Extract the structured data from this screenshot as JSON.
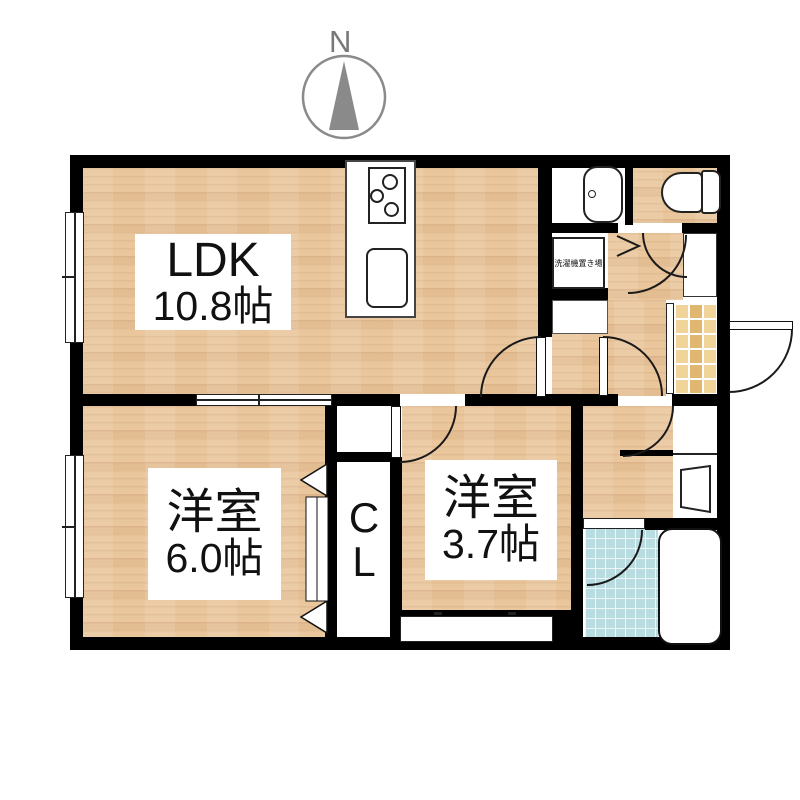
{
  "compass": {
    "label": "N"
  },
  "rooms": {
    "ldk": {
      "name": "LDK",
      "area": "10.8帖"
    },
    "western1": {
      "name": "洋室",
      "area": "6.0帖"
    },
    "western2": {
      "name": "洋室",
      "area": "3.7帖"
    },
    "closet": {
      "label": "CL"
    },
    "laundry": {
      "label": "洗濯機置き場"
    }
  },
  "fixtures": [
    "compass-icon",
    "gas-stove-icon",
    "kitchen-sink-icon",
    "vanity-basin-icon",
    "toilet-icon",
    "washing-machine-area",
    "shoe-cabinet",
    "washbasin-icon",
    "bathtub-icon",
    "door-swing-arc",
    "folding-door-icon",
    "sliding-window-icon"
  ],
  "colors": {
    "wall": "#000000",
    "wood_floor": "#eac69c",
    "entrance_tile": "#e0b76e",
    "bath_tile": "#b9dce1",
    "compass_gray": "#8a8a8a",
    "text": "#111111"
  }
}
